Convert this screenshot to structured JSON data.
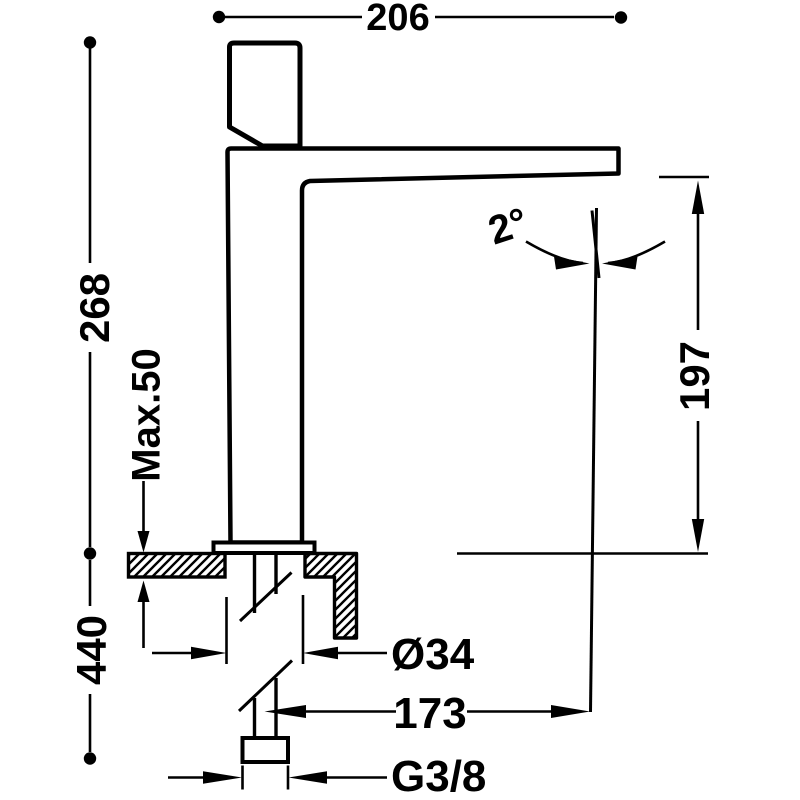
{
  "drawing": {
    "title": "Basin mixer tap — side elevation installation drawing",
    "background": "#ffffff",
    "ink_color": "#000000",
    "dims": {
      "spout_length": "206",
      "height_above_deck": "268",
      "max_deck_thickness": "Max.50",
      "below_deck_length": "440",
      "spout_angle": "2°",
      "outlet_height": "197",
      "body_diameter": "Ø34",
      "outlet_reach": "173",
      "supply_thread": "G3/8"
    }
  }
}
